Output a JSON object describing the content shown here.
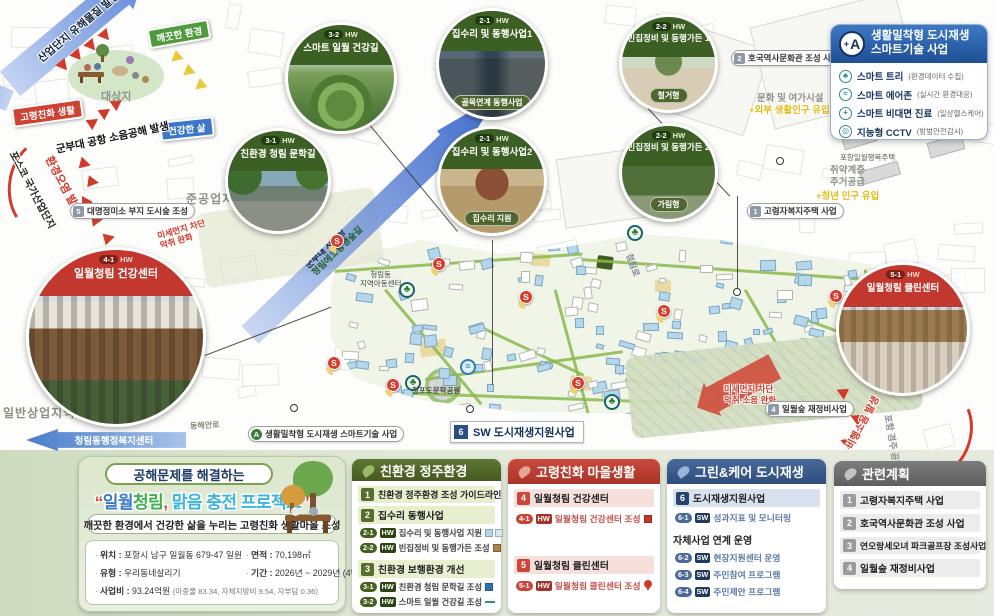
{
  "colors": {
    "green": "#4f6a2a",
    "red": "#c0463a",
    "blue": "#3c5f8e",
    "gray": "#6f6f6f",
    "accent_yellow": "#e3bc1a",
    "map_building_blue": "#b4d7ec"
  },
  "diagram": {
    "industry_arrow": "산업단지 유해물질 발생",
    "clean_env": "깨끗한 환경",
    "aging_life": "고령친화 생활",
    "healthy_life": "건강한 삶",
    "site": "대상지",
    "noise": "군부대 공항 소음공해 발생",
    "posco": "포스코 국가산업단지",
    "pollution": "환경오염 발생"
  },
  "callouts": [
    {
      "code": "3-2",
      "tag": "HW",
      "title": "스마트 일월 건강길",
      "theme": "green"
    },
    {
      "code": "3-1",
      "tag": "HW",
      "title": "친환경 청림 문학길",
      "theme": "green"
    },
    {
      "code": "2-1",
      "tag": "HW",
      "title": "집수리 및 동행사업1",
      "sub": "골목연계 동행사업",
      "theme": "green"
    },
    {
      "code": "2-1",
      "tag": "HW",
      "title": "집수리 및 동행사업2",
      "sub": "집수리 지원",
      "theme": "green"
    },
    {
      "code": "2-2",
      "tag": "HW",
      "title": "빈집정비 및 동행가든 1",
      "sub": "철거형",
      "theme": "green"
    },
    {
      "code": "2-2",
      "tag": "HW",
      "title": "빈집정비 및 동행가든 2",
      "sub": "가림형",
      "theme": "green"
    },
    {
      "code": "4-1",
      "tag": "HW",
      "title": "일월청림 건강센터",
      "theme": "red"
    },
    {
      "code": "5-1",
      "tag": "HW",
      "title": "일월청림 클린센터",
      "theme": "red"
    }
  ],
  "smart_legend": {
    "badge_plus": "+",
    "badge": "A",
    "title1": "생활밀착형 도시재생",
    "title2": "스마트기술 사업",
    "items": [
      {
        "icon": "tree-icon",
        "glyph": "♣",
        "label": "스마트 트리",
        "note": "(환경데이터 수집)"
      },
      {
        "icon": "air-icon",
        "glyph": "≈",
        "label": "스마트 에어존",
        "note": "(실시간 환경대응)"
      },
      {
        "icon": "medical-icon",
        "glyph": "+",
        "label": "스마트 비대면 진료",
        "note": "(일상헬스케어)"
      },
      {
        "icon": "cctv-icon",
        "glyph": "◎",
        "label": "지능형 CCTV",
        "note": "(방범안전감시)"
      }
    ]
  },
  "map": {
    "s_letter": "S",
    "pills": {
      "mill": {
        "badge": "5",
        "text": "대명정미소 부지 도시숲 조성"
      },
      "hoguk": {
        "badge": "2",
        "text": "호국역사문화관 조성 사업"
      },
      "welfare": {
        "badge": "1",
        "text": "고령자복지주택 사업"
      },
      "forest": {
        "badge": "4",
        "text": "일월숲 재정비사업"
      },
      "smart": {
        "badge": "A",
        "text": "생활밀착형 도시재생 스마트기술 사업"
      },
      "sw": {
        "badge": "6",
        "text": "SW 도시재생지원사업"
      }
    },
    "labels": {
      "semi_industrial": "준공업지역",
      "commercial": "일반상업지역",
      "culture": "문화 및 여가시설",
      "culture_plus": "+외부 생활인구 유입",
      "housing1": "취약계층",
      "housing2": "주거공급",
      "housing_plus": "+청년 인구 유입",
      "happy_house": "포항일월행복주택",
      "child_center1": "청림동",
      "child_center2": "지역아동센터",
      "park": "청포도문학공원",
      "road_donghaean": "동해안로",
      "road_cheonglim": "청림로",
      "airport": "포항 경주 공항",
      "flight_noise": "비행소음 발생",
      "dust_left1": "미세먼지 차단",
      "dust_left2": "악취 완화",
      "dust_right1": "미세먼지 차단",
      "dust_right2": "악취·소음 완화",
      "arrow_line1": "군부대 사격장",
      "arrow_line2": "청림에코동행숲길",
      "welfare_center": "청림동행정복지센터"
    }
  },
  "project": {
    "tagline": "공해문제를 해결하는",
    "quote_open": "“",
    "part1": "일월",
    "part2": "청림",
    "comma": ",",
    "part3": " 맑음 충전 프로젝트",
    "quote_close": "”",
    "subtitle": "깨끗한 환경에서 건강한 삶을 누리는 고령친화 생활마을 조성",
    "info": {
      "loc_label": "위치 :",
      "loc": "포항시 남구 일월동 679-47 일원",
      "area_label": "면적 :",
      "area": "70,198㎡",
      "type_label": "유형 :",
      "type": "우리동네살리기",
      "period_label": "기간 :",
      "period": "2026년 ~ 2029년 (4년간)",
      "budget_label": "사업비 :",
      "budget": "93.24억원",
      "budget_note": "(마중물 83.34, 자체지방비 9.54, 자부담 0.36)"
    }
  },
  "panel_eco": {
    "title": "친환경 정주환경",
    "g1_badge": "1",
    "g1_title": "친환경 정주환경 조성 가이드라인",
    "g2_badge": "2",
    "g2_title": "집수리 동행사업",
    "g2_items": [
      {
        "code": "2-1",
        "tag": "HW",
        "text": "집수리 및 동행사업 지원"
      },
      {
        "code": "2-2",
        "tag": "HW",
        "text": "빈집정비 및 동행가든 조성"
      }
    ],
    "g3_badge": "3",
    "g3_title": "친환경 보행환경 개선",
    "g3_items": [
      {
        "code": "3-1",
        "tag": "HW",
        "text": "친환경 청림 문학길 조성"
      },
      {
        "code": "3-2",
        "tag": "HW",
        "text": "스마트 일월 건강길 조성"
      }
    ]
  },
  "panel_aging": {
    "title": "고령친화 마을생활",
    "g1_badge": "4",
    "g1_title": "일월청림 건강센터",
    "g1_item": {
      "code": "4-1",
      "tag": "HW",
      "text": "일월청림 건강센터 조성"
    },
    "g2_badge": "5",
    "g2_title": "일월청림 클린센터",
    "g2_item": {
      "code": "5-1",
      "tag": "HW",
      "text": "일월청림 클린센터 조성"
    }
  },
  "panel_green": {
    "title": "그린&케어 도시재생",
    "g1_badge": "6",
    "g1_title": "도시재생지원사업",
    "g1_item": {
      "code": "6-1",
      "tag": "SW",
      "text": "성과지표 및 모니터링"
    },
    "sub_title": "자체사업 연계 운영",
    "sub_items": [
      {
        "code": "6-2",
        "tag": "SW",
        "text": "현장지원센터 운영"
      },
      {
        "code": "6-3",
        "tag": "SW",
        "text": "주민참여 프로그램"
      },
      {
        "code": "6-4",
        "tag": "SW",
        "text": "주민제안 프로그램"
      }
    ]
  },
  "panel_related": {
    "title": "관련계획",
    "items": [
      {
        "badge": "1",
        "text": "고령자복지주택 사업"
      },
      {
        "badge": "2",
        "text": "호국역사문화관 조성 사업"
      },
      {
        "badge": "3",
        "text": "연오랑세오녀 파크골프장 조성사업"
      },
      {
        "badge": "4",
        "text": "일월숲 재정비사업"
      }
    ]
  }
}
